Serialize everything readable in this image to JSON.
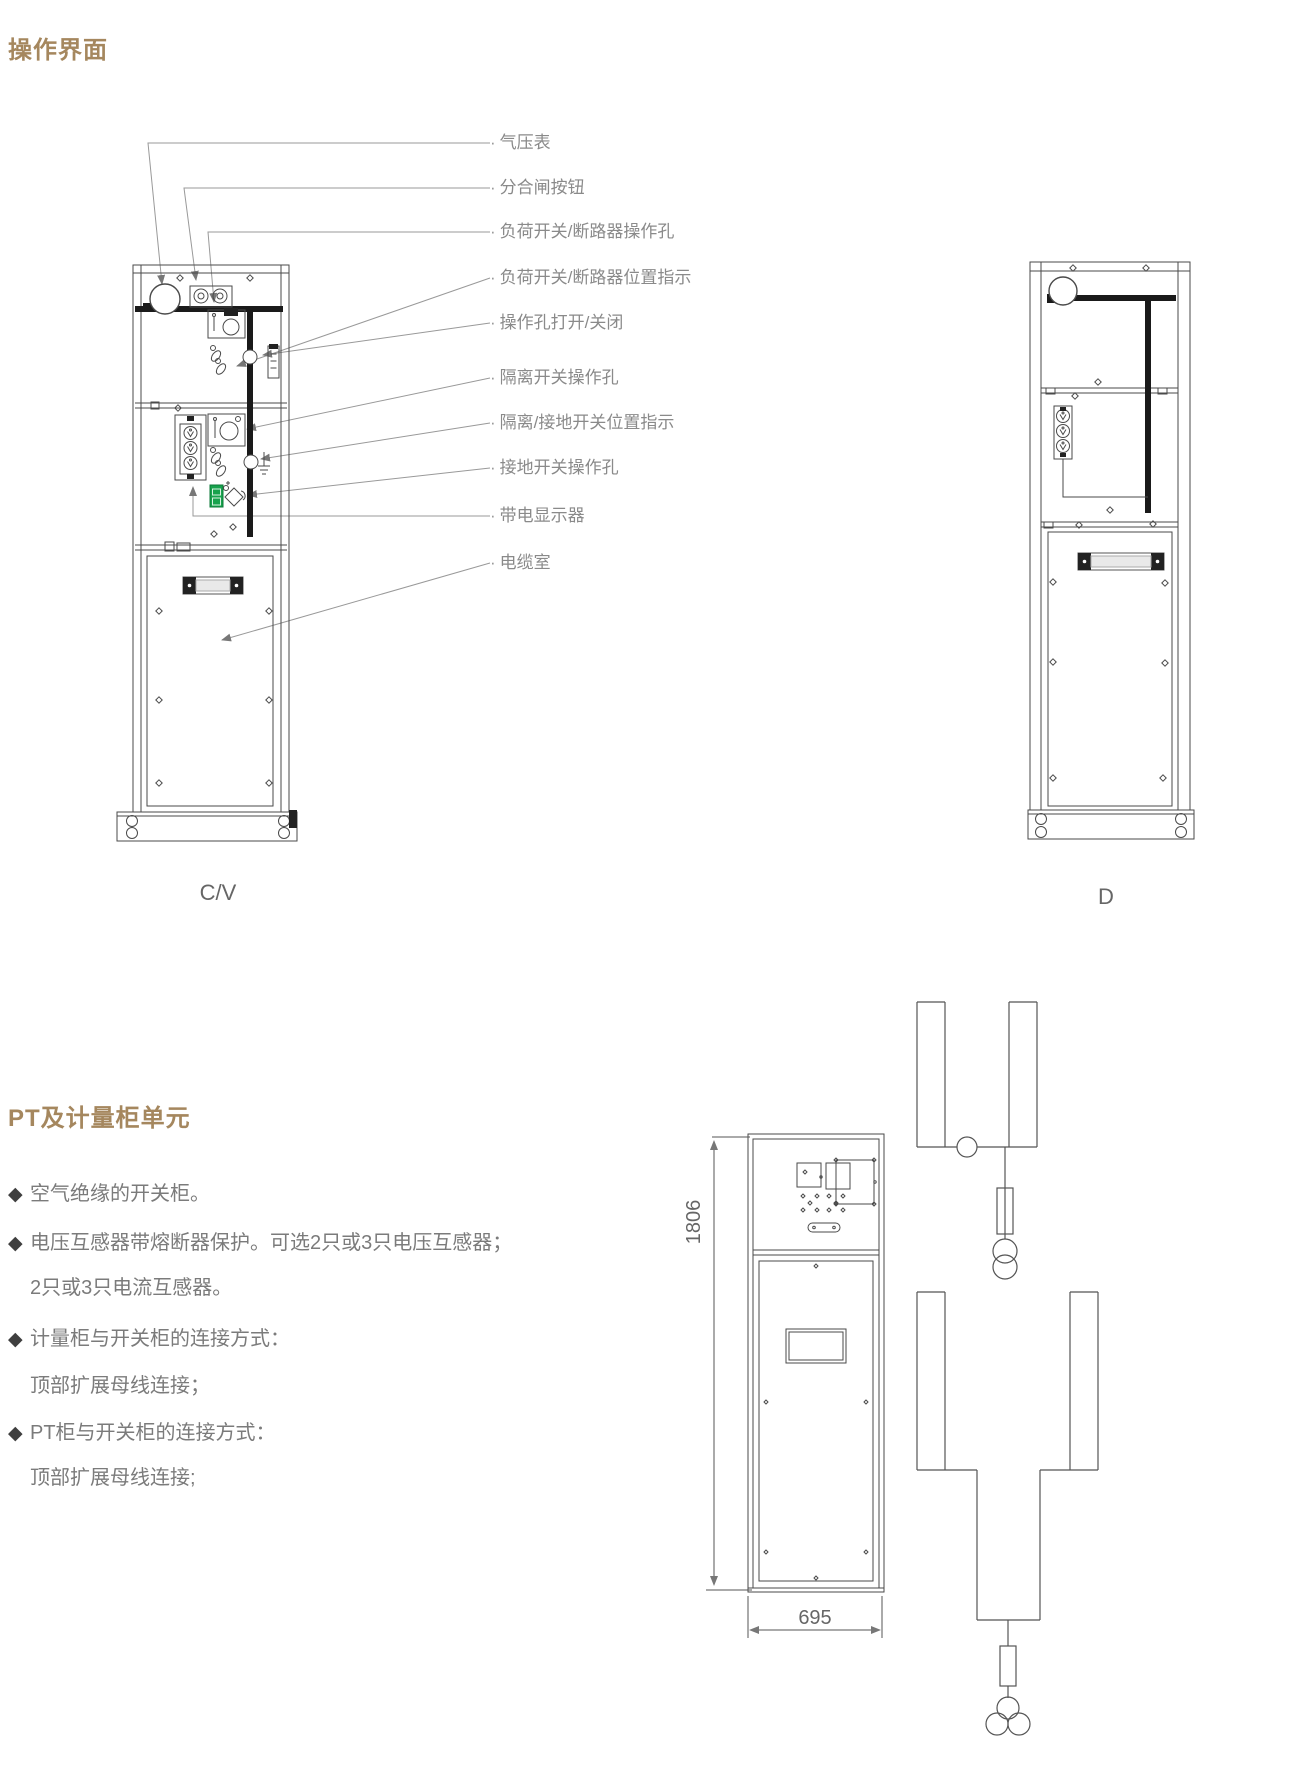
{
  "page": {
    "section1_title": "操作界面",
    "section2_title": "PT及计量柜单元"
  },
  "figure_operation": {
    "callout_prefix": "·",
    "callouts": [
      {
        "text": "气压表"
      },
      {
        "text": "分合闸按钮"
      },
      {
        "text": "负荷开关/断路器操作孔"
      },
      {
        "text": "负荷开关/断路器位置指示"
      },
      {
        "text": "操作孔打开/关闭"
      },
      {
        "text": "隔离开关操作孔"
      },
      {
        "text": "隔离/接地开关位置指示"
      },
      {
        "text": "接地开关操作孔"
      },
      {
        "text": "带电显示器"
      },
      {
        "text": "电缆室"
      }
    ],
    "cabinet_left_label": "C/V",
    "cabinet_right_label": "D"
  },
  "pt_section": {
    "bullets": [
      {
        "marker": "◆",
        "text": "空气绝缘的开关柜。"
      },
      {
        "marker": "◆",
        "text": "电压互感器带熔断器保护。可选2只或3只电压互感器；"
      },
      {
        "marker": "",
        "text": "2只或3只电流互感器。"
      },
      {
        "marker": "◆",
        "text": "计量柜与开关柜的连接方式："
      },
      {
        "marker": "",
        "text": "顶部扩展母线连接；"
      },
      {
        "marker": "◆",
        "text": "PT柜与开关柜的连接方式："
      },
      {
        "marker": "",
        "text": "顶部扩展母线连接;"
      }
    ],
    "dimensions": {
      "height": "1806",
      "width": "695"
    }
  },
  "colors": {
    "heading": "#a5875e",
    "label_text": "#8a8a8a",
    "bullet_text": "#7b7b7b",
    "line_art": "#4a4a4a",
    "busbar": "#1a1a1a",
    "green_indicator": "#18a24d",
    "leader_line": "#999999",
    "dimension_text": "#666666"
  }
}
